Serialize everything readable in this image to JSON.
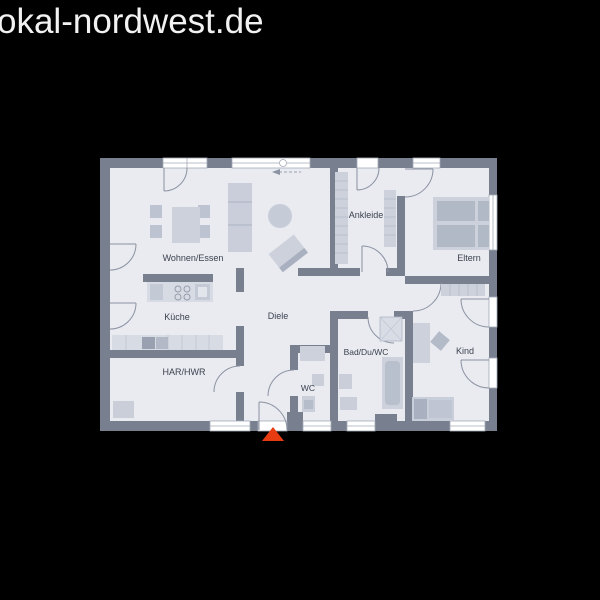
{
  "page": {
    "title": "okal-nordwest.de",
    "background": "#000000"
  },
  "floorplan": {
    "type": "bungalow-floor-plan",
    "colors": {
      "wall": "#78808f",
      "floor": "#e9ebf1",
      "furniture_light": "#ccd1dc",
      "furniture_mid": "#b9c0cd",
      "furniture_dark": "#a9b0bf",
      "counter": "#d7dbe4",
      "window": "#ffffff",
      "window_frame": "#a3aab7",
      "door_arc": "#8b92a1",
      "label": "#3c414d",
      "entrance_marker": "#e73c12"
    },
    "rooms": {
      "wohnen": "Wohnen/Essen",
      "ankleide": "Ankleide",
      "eltern": "Eltern",
      "kueche": "Küche",
      "diele": "Diele",
      "bad": "Bad/Du/WC",
      "kind": "Kind",
      "har": "HAR/HWR",
      "wc": "WC"
    },
    "entrance_marker": {
      "shape": "triangle-up",
      "color": "#e73c12"
    }
  }
}
